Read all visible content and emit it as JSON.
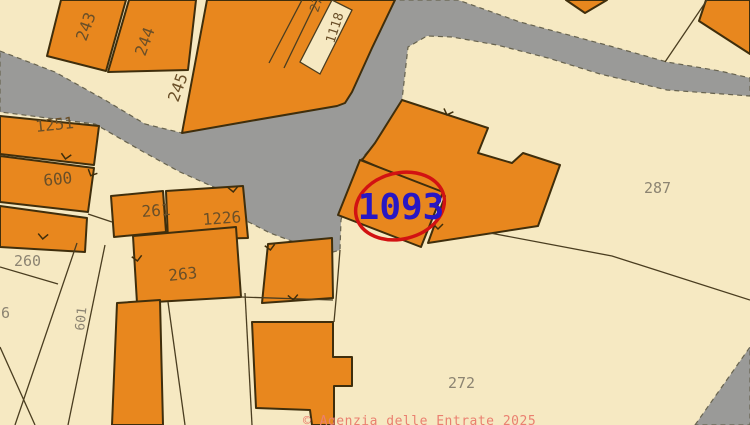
{
  "app": {
    "watermark": "© Agenzia delle Entrate 2025"
  },
  "map": {
    "width": 750,
    "height": 425,
    "colors": {
      "background": "#f6e9c2",
      "building_fill": "#e8871e",
      "building_stroke": "#3f2e0c",
      "road_fill": "#9a9a98",
      "road_stroke": "#67634f",
      "parcel_line": "#4a3d20",
      "building_label": "#6a4f28",
      "parcel_label": "#8c8472",
      "highlight_text": "#2817c4",
      "highlight_circle": "#d21212",
      "watermark": "#ea8070"
    },
    "highlight": {
      "parcel": "1093",
      "x": 401,
      "y": 219,
      "size": 36,
      "ellipse": {
        "cx": 400,
        "cy": 206,
        "rx": 45,
        "ry": 33,
        "rot": -14,
        "width": 3.5
      }
    },
    "roads": [
      {
        "name": "road-main",
        "pts": "0,51 55,72 105,100 145,124 182,133 250,121 337,106 345,103 352,92 372,48 395,0 458,0 520,22 550,30 610,46 667,62 720,71 750,78 750,96 667,90 600,74 548,58 497,45 452,37 427,36 408,47 402,100 375,143 358,163 341,220 340,250 333,252 305,246 270,233 233,214 225,192 180,172 140,150 95,124 0,112"
      },
      {
        "name": "road-corner-bottom-right",
        "pts": "695,425 750,347 750,425"
      }
    ],
    "buildings": [
      {
        "name": "building-top-block",
        "pts": "207,0 395,0 372,48 352,92 345,103 337,106 250,121 182,133"
      },
      {
        "name": "building-243",
        "pts": "61,0 126,0 106,71 47,56"
      },
      {
        "name": "building-244",
        "pts": "129,0 196,0 188,70 108,72"
      },
      {
        "name": "building-top-right-corner",
        "pts": "706,0 750,0 750,54 699,21"
      },
      {
        "name": "building-triangle-small",
        "pts": "566,0 607,0 585,13"
      },
      {
        "name": "building-1251",
        "pts": "0,116 99,126 94,165 0,154"
      },
      {
        "name": "building-600",
        "pts": "0,156 94,168 88,212 0,202"
      },
      {
        "name": "building-600-annex",
        "pts": "0,206 87,218 85,252 0,247"
      },
      {
        "name": "building-261",
        "pts": "111,196 163,191 166,232 114,237"
      },
      {
        "name": "building-1226",
        "pts": "166,191 243,186 248,238 168,240"
      },
      {
        "name": "building-263",
        "pts": "133,236 236,227 241,297 137,303"
      },
      {
        "name": "building-tall-left",
        "pts": "117,303 160,300 163,425 112,425"
      },
      {
        "name": "building-mid",
        "pts": "268,244 332,238 333,298 262,303"
      },
      {
        "name": "building-bottom",
        "pts": "252,322 333,322 333,357 352,357 352,386 334,386 334,425 312,425 310,410 256,408"
      },
      {
        "name": "building-main-L",
        "pts": "402,100 488,128 478,153 512,163 523,153 560,165 538,226 428,243 445,196 362,160 375,143"
      },
      {
        "name": "building-1093",
        "pts": "360,160 443,192 421,247 338,215"
      }
    ],
    "slivers": [
      {
        "name": "parcel-sliver-1118",
        "pts": "332,0 352,10 320,74 300,62"
      }
    ],
    "lines": [
      {
        "pts": "707,0 665,62"
      },
      {
        "pts": "490,233 612,256 750,300"
      },
      {
        "pts": "0,267 58,284"
      },
      {
        "pts": "77,243 15,425"
      },
      {
        "pts": "105,245 68,425"
      },
      {
        "pts": "0,347 35,425"
      },
      {
        "pts": "168,302 185,425"
      },
      {
        "pts": "240,297 333,300"
      },
      {
        "pts": "340,250 336,300 334,322"
      },
      {
        "pts": "245,293 252,425"
      },
      {
        "pts": "88,214 112,222"
      },
      {
        "pts": "317,0 284,68"
      },
      {
        "pts": "302,0 269,63"
      }
    ],
    "ticks": [
      {
        "x": 66,
        "y": 156,
        "r": 10
      },
      {
        "x": 92,
        "y": 173,
        "r": 25
      },
      {
        "x": 43,
        "y": 236,
        "r": 5
      },
      {
        "x": 137,
        "y": 258,
        "r": -8
      },
      {
        "x": 233,
        "y": 189,
        "r": -5
      },
      {
        "x": 270,
        "y": 247,
        "r": -8
      },
      {
        "x": 448,
        "y": 112,
        "r": 20
      },
      {
        "x": 438,
        "y": 226,
        "r": 0
      },
      {
        "x": 293,
        "y": 297,
        "r": -5
      }
    ],
    "labels": [
      {
        "t": "243",
        "x": 86,
        "y": 42,
        "r": -70,
        "s": 16,
        "c": "lbl-bld"
      },
      {
        "t": "244",
        "x": 145,
        "y": 57,
        "r": -70,
        "s": 16,
        "c": "lbl-bld"
      },
      {
        "t": "245",
        "x": 178,
        "y": 103,
        "r": -70,
        "s": 16,
        "c": "lbl-bld"
      },
      {
        "t": "2712",
        "x": 318,
        "y": 13,
        "r": -72,
        "s": 13,
        "c": "lbl-bld"
      },
      {
        "t": "1118",
        "x": 334,
        "y": 44,
        "r": -72,
        "s": 13,
        "c": "lbl-bld"
      },
      {
        "t": "1251",
        "x": 36,
        "y": 132,
        "r": -6,
        "s": 16,
        "c": "lbl-bld"
      },
      {
        "t": "600",
        "x": 44,
        "y": 186,
        "r": -6,
        "s": 16,
        "c": "lbl-bld"
      },
      {
        "t": "261",
        "x": 142,
        "y": 217,
        "r": -4,
        "s": 16,
        "c": "lbl-bld"
      },
      {
        "t": "1226",
        "x": 203,
        "y": 225,
        "r": -4,
        "s": 16,
        "c": "lbl-bld"
      },
      {
        "t": "263",
        "x": 169,
        "y": 281,
        "r": -6,
        "s": 16,
        "c": "lbl-bld"
      },
      {
        "t": "260",
        "x": 14,
        "y": 266,
        "r": 0,
        "s": 15,
        "c": "lbl-parc"
      },
      {
        "t": "6",
        "x": 1,
        "y": 318,
        "r": 0,
        "s": 15,
        "c": "lbl-parc"
      },
      {
        "t": "601",
        "x": 84,
        "y": 331,
        "r": -84,
        "s": 13,
        "c": "lbl-parc"
      },
      {
        "t": "287",
        "x": 644,
        "y": 193,
        "r": 0,
        "s": 15,
        "c": "lbl-parc"
      },
      {
        "t": "272",
        "x": 448,
        "y": 388,
        "r": 0,
        "s": 15,
        "c": "lbl-parc"
      }
    ]
  }
}
